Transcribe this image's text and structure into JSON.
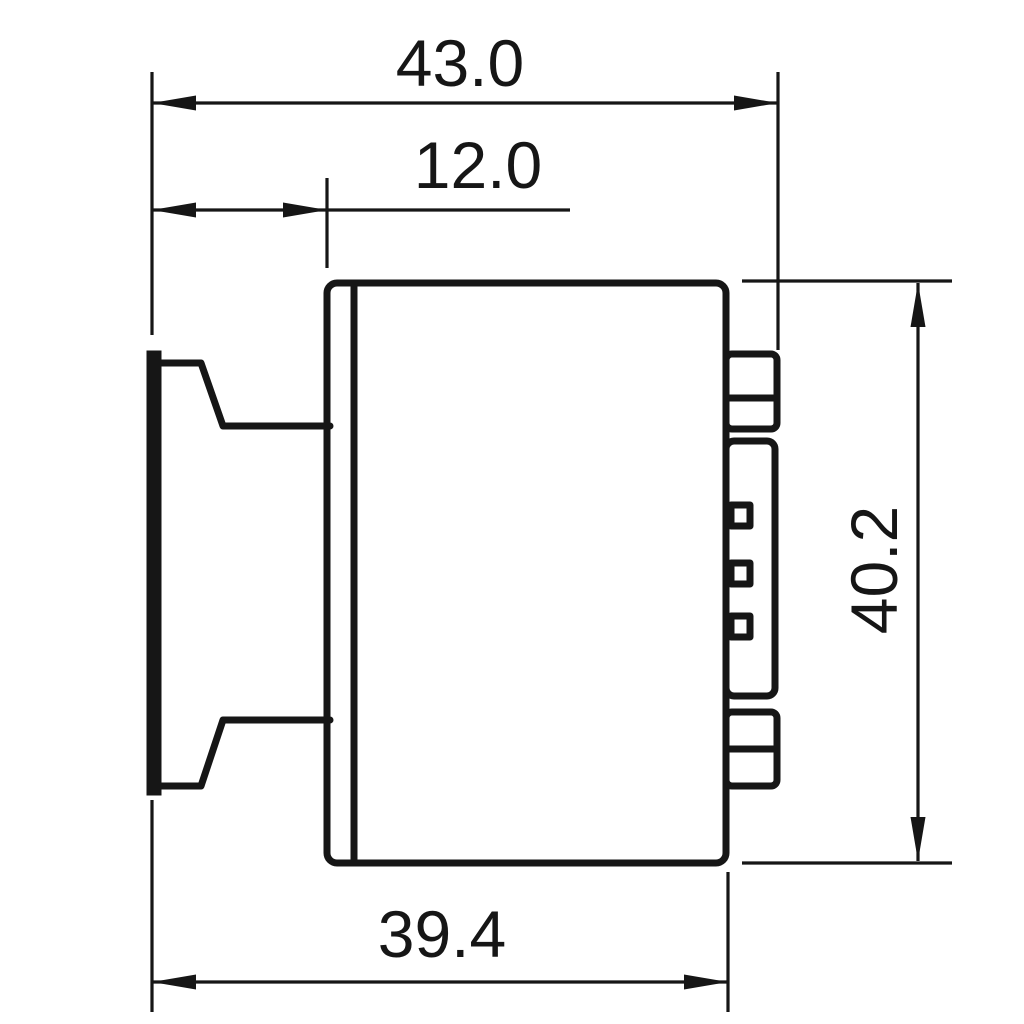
{
  "colors": {
    "background": "#ffffff",
    "line": "#161616"
  },
  "drawing": {
    "dimensions": {
      "overall_width": {
        "label": "43.0"
      },
      "flange_offset": {
        "label": "12.0"
      },
      "body_width": {
        "label": "39.4"
      },
      "body_height": {
        "label": "40.2"
      }
    }
  }
}
